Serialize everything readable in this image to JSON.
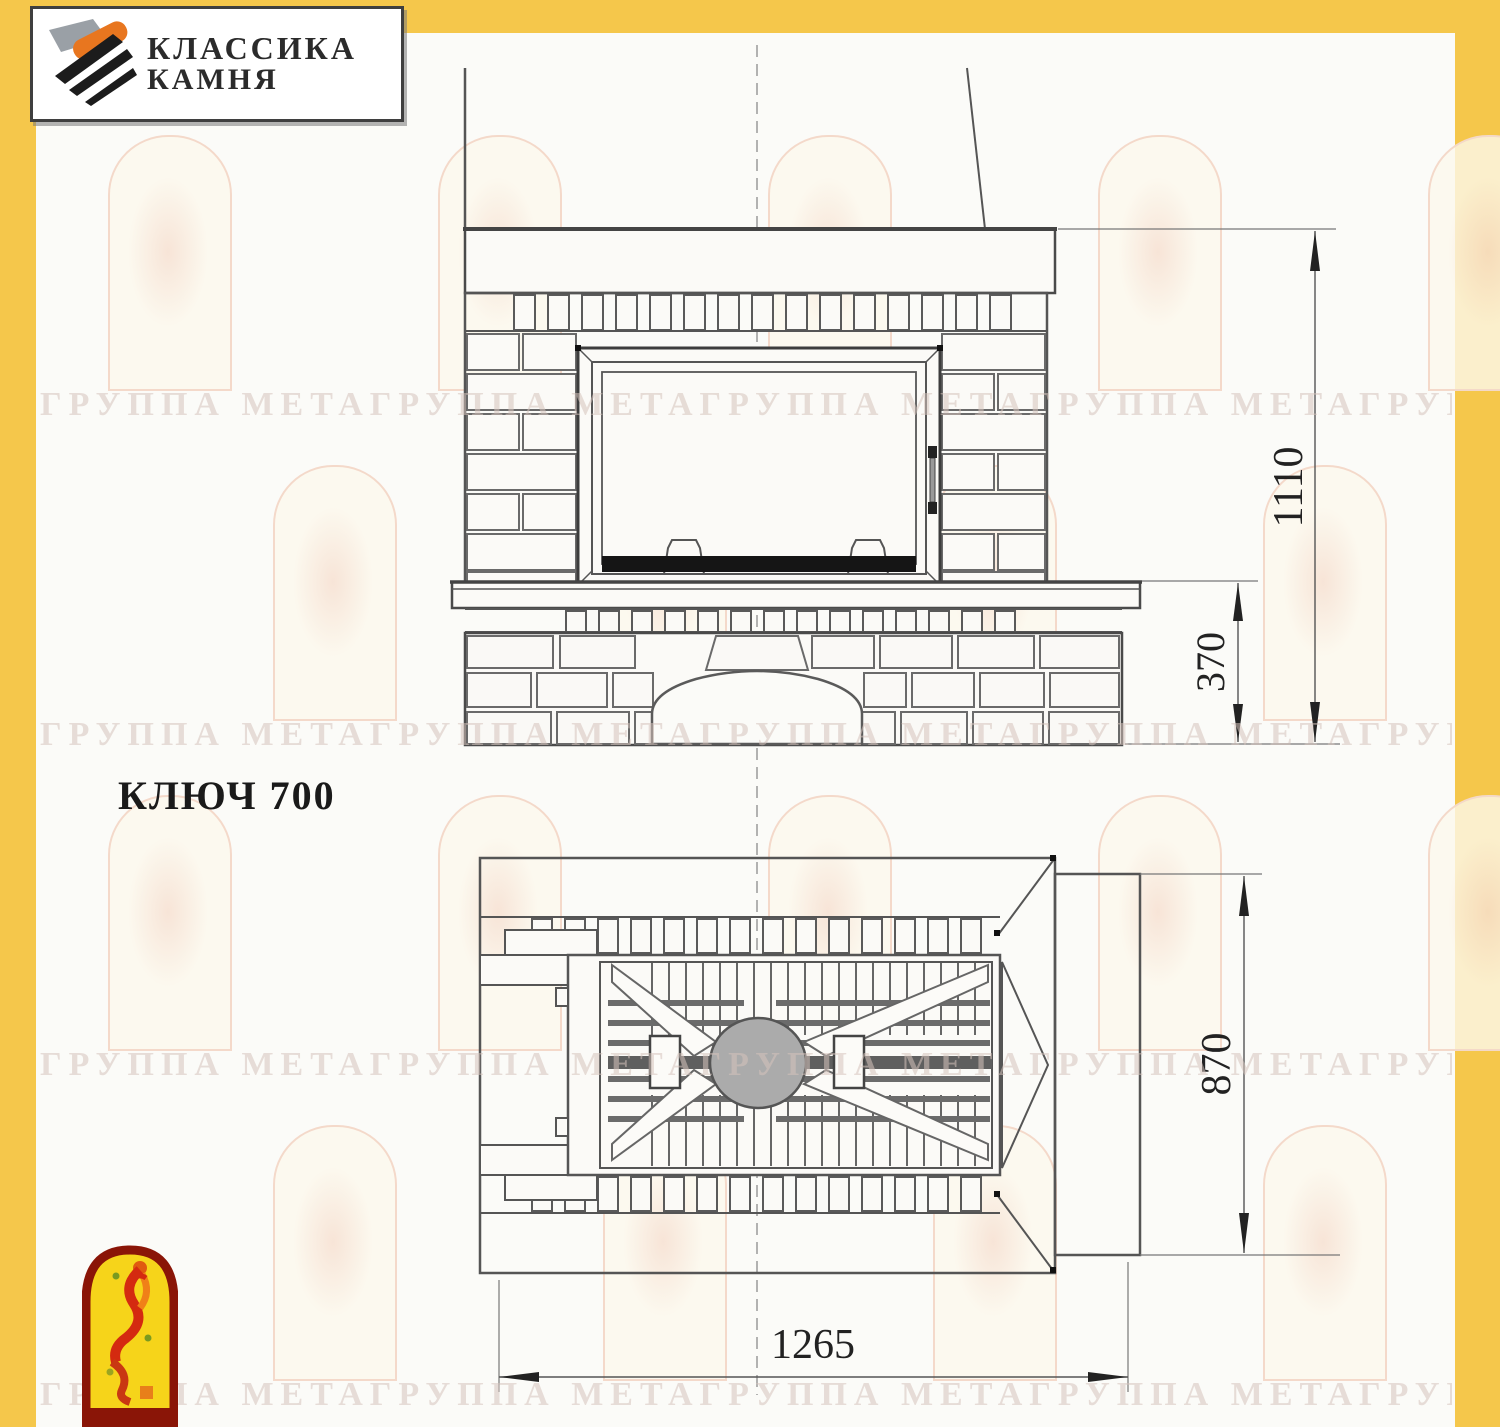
{
  "colors": {
    "border_yellow": "#f5c74b",
    "drawing_line": "#555555",
    "watermark_pink": "#d6c3bc",
    "emblem_red": "#8a1507",
    "emblem_yellow": "#f6d41a",
    "logo_orange": "#e8761f"
  },
  "logo": {
    "line1": "КЛАССИКА",
    "line2": "КАМНЯ"
  },
  "product": {
    "title": "КЛЮЧ 700"
  },
  "dimensions": {
    "front_height": "1110",
    "hearth_height": "370",
    "plan_depth": "870",
    "plan_width": "1265"
  },
  "watermark": {
    "row_text": "ГРУППА МЕТАГРУППА МЕТАГРУППА МЕТАГРУППА МЕТАГРУППА МЕТА"
  },
  "icons": {
    "logo": "stone-stack-icon",
    "emblem": "dancing-flame-icon"
  }
}
